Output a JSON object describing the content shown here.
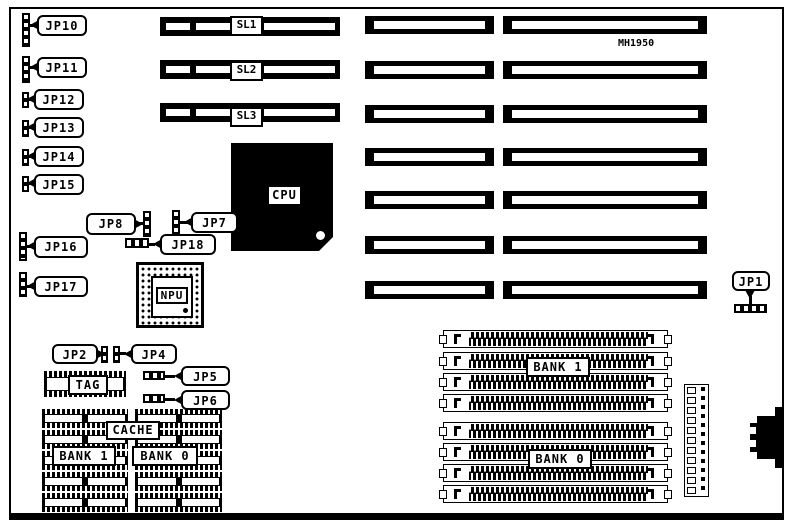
{
  "board": {
    "part_number": "MH1950"
  },
  "slots": {
    "sl1": "SL1",
    "sl2": "SL2",
    "sl3": "SL3"
  },
  "jumpers": {
    "jp1": "JP1",
    "jp2": "JP2",
    "jp4": "JP4",
    "jp5": "JP5",
    "jp6": "JP6",
    "jp7": "JP7",
    "jp8": "JP8",
    "jp10": "JP10",
    "jp11": "JP11",
    "jp12": "JP12",
    "jp13": "JP13",
    "jp14": "JP14",
    "jp15": "JP15",
    "jp16": "JP16",
    "jp17": "JP17",
    "jp18": "JP18"
  },
  "chips": {
    "cpu": "CPU",
    "npu": "NPU",
    "tag": "TAG",
    "cache": "CACHE"
  },
  "memory": {
    "cache_bank1": "BANK 1",
    "cache_bank0": "BANK 0",
    "simm_bank1": "BANK 1",
    "simm_bank0": "BANK 0"
  },
  "colors": {
    "ink": "#000000",
    "paper": "#ffffff"
  }
}
